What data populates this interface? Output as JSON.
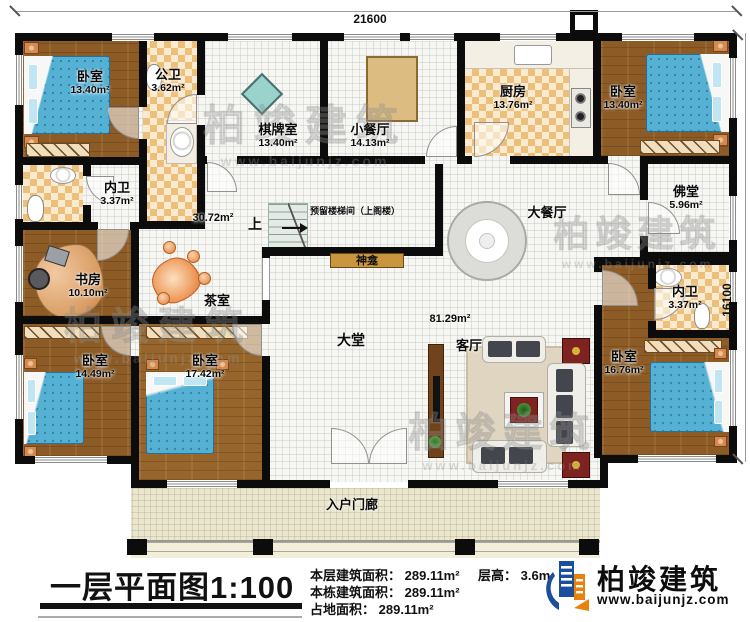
{
  "dimensions": {
    "top": "21600",
    "right": "16100"
  },
  "rooms": [
    {
      "name": "卧室",
      "area": "13.40m²"
    },
    {
      "name": "公卫",
      "area": "3.62m²"
    },
    {
      "name": "棋牌室",
      "area": "13.40m²"
    },
    {
      "name": "小餐厅",
      "area": "14.13m²"
    },
    {
      "name": "厨房",
      "area": "13.76m²"
    },
    {
      "name": "卧室",
      "area": "13.40m²"
    },
    {
      "name": "内卫",
      "area": "3.37m²"
    },
    {
      "name": "佛堂",
      "area": "5.96m²"
    },
    {
      "name": "书房",
      "area": "10.10m²"
    },
    {
      "name": "茶室",
      "area": ""
    },
    {
      "name": "大餐厅",
      "area": ""
    },
    {
      "name": "内卫",
      "area": "3.37m²"
    },
    {
      "name": "卧室",
      "area": "14.49m²"
    },
    {
      "name": "卧室",
      "area": "17.42m²"
    },
    {
      "name": "大堂",
      "area": ""
    },
    {
      "name": "客厅",
      "area": ""
    },
    {
      "name": "卧室",
      "area": "16.76m²"
    },
    {
      "name": "入户门廊",
      "area": ""
    }
  ],
  "open_labels": {
    "hall_area": "30.72m²",
    "lobby_area": "81.29m²"
  },
  "stairs": {
    "direction": "上",
    "label": "预留楼梯间（上阁楼）"
  },
  "shrine": {
    "label": "神龛"
  },
  "watermark": {
    "text": "柏竣建筑",
    "url": "www.baijunjz.com"
  },
  "footer": {
    "title": "一层平面图1:100",
    "stats": [
      {
        "label": "本层建筑面积：",
        "value": "289.11m²"
      },
      {
        "label": "本栋建筑面积：",
        "value": "289.11m²"
      },
      {
        "label": "占地面积：",
        "value": "289.11m²"
      }
    ],
    "floor_height": {
      "label": "层高：",
      "value": "3.6m"
    },
    "logo": {
      "name": "柏竣建筑",
      "url": "www.baijunjz.com"
    }
  }
}
